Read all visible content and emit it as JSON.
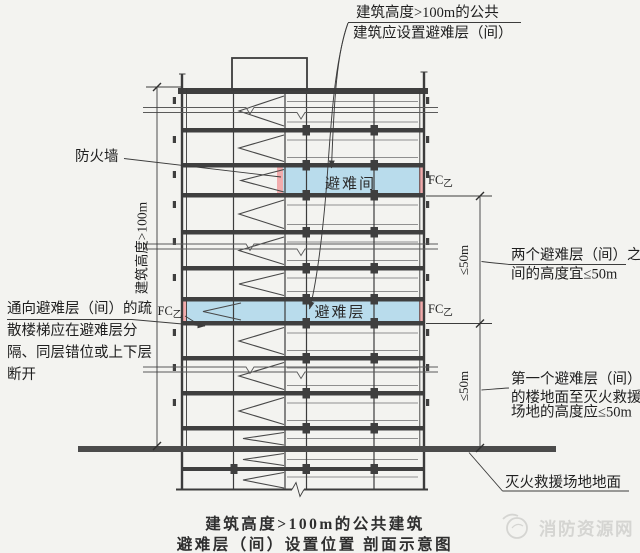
{
  "colors": {
    "background": "#f3f3f0",
    "line_dark": "#3c3c3c",
    "refuge_fill": "#b9dcec",
    "firewall_fill": "#f2abac",
    "ground_bar": "#4b4b4b",
    "watermark": "#d5d5d2"
  },
  "annotations": {
    "top_note": {
      "line1": "建筑高度>100m的公共",
      "line2": "建筑应设置避难层（间）"
    },
    "firewall_label": "防火墙",
    "building_height_dim": "建筑高度>100m",
    "stair_note": {
      "line1": "通向避难层（间）的疏",
      "line2": "散楼梯应在避难层分",
      "line3": "隔、同层错位或上下层",
      "line4": "断开"
    },
    "spacing_note": {
      "line1": "两个避难层（间）之",
      "line2": "间的高度宜≤50m"
    },
    "first_refuge_note": {
      "line1": "第一个避难层（间）",
      "line2": "的楼地面至灭火救援",
      "line3": "场地的高度应≤50m"
    },
    "rescue_ground_label": "灭火救援场地地面",
    "dim_upper": "≤50m",
    "dim_lower": "≤50m",
    "fire_window": {
      "prefix": "FC",
      "class": "乙"
    }
  },
  "building": {
    "refuge_room": "避难间",
    "refuge_floor": "避难层"
  },
  "caption": {
    "line1": "建筑高度>100m的公共建筑",
    "line2": "避难层（间）设置位置 剖面示意图"
  },
  "watermark": "消防资源网"
}
